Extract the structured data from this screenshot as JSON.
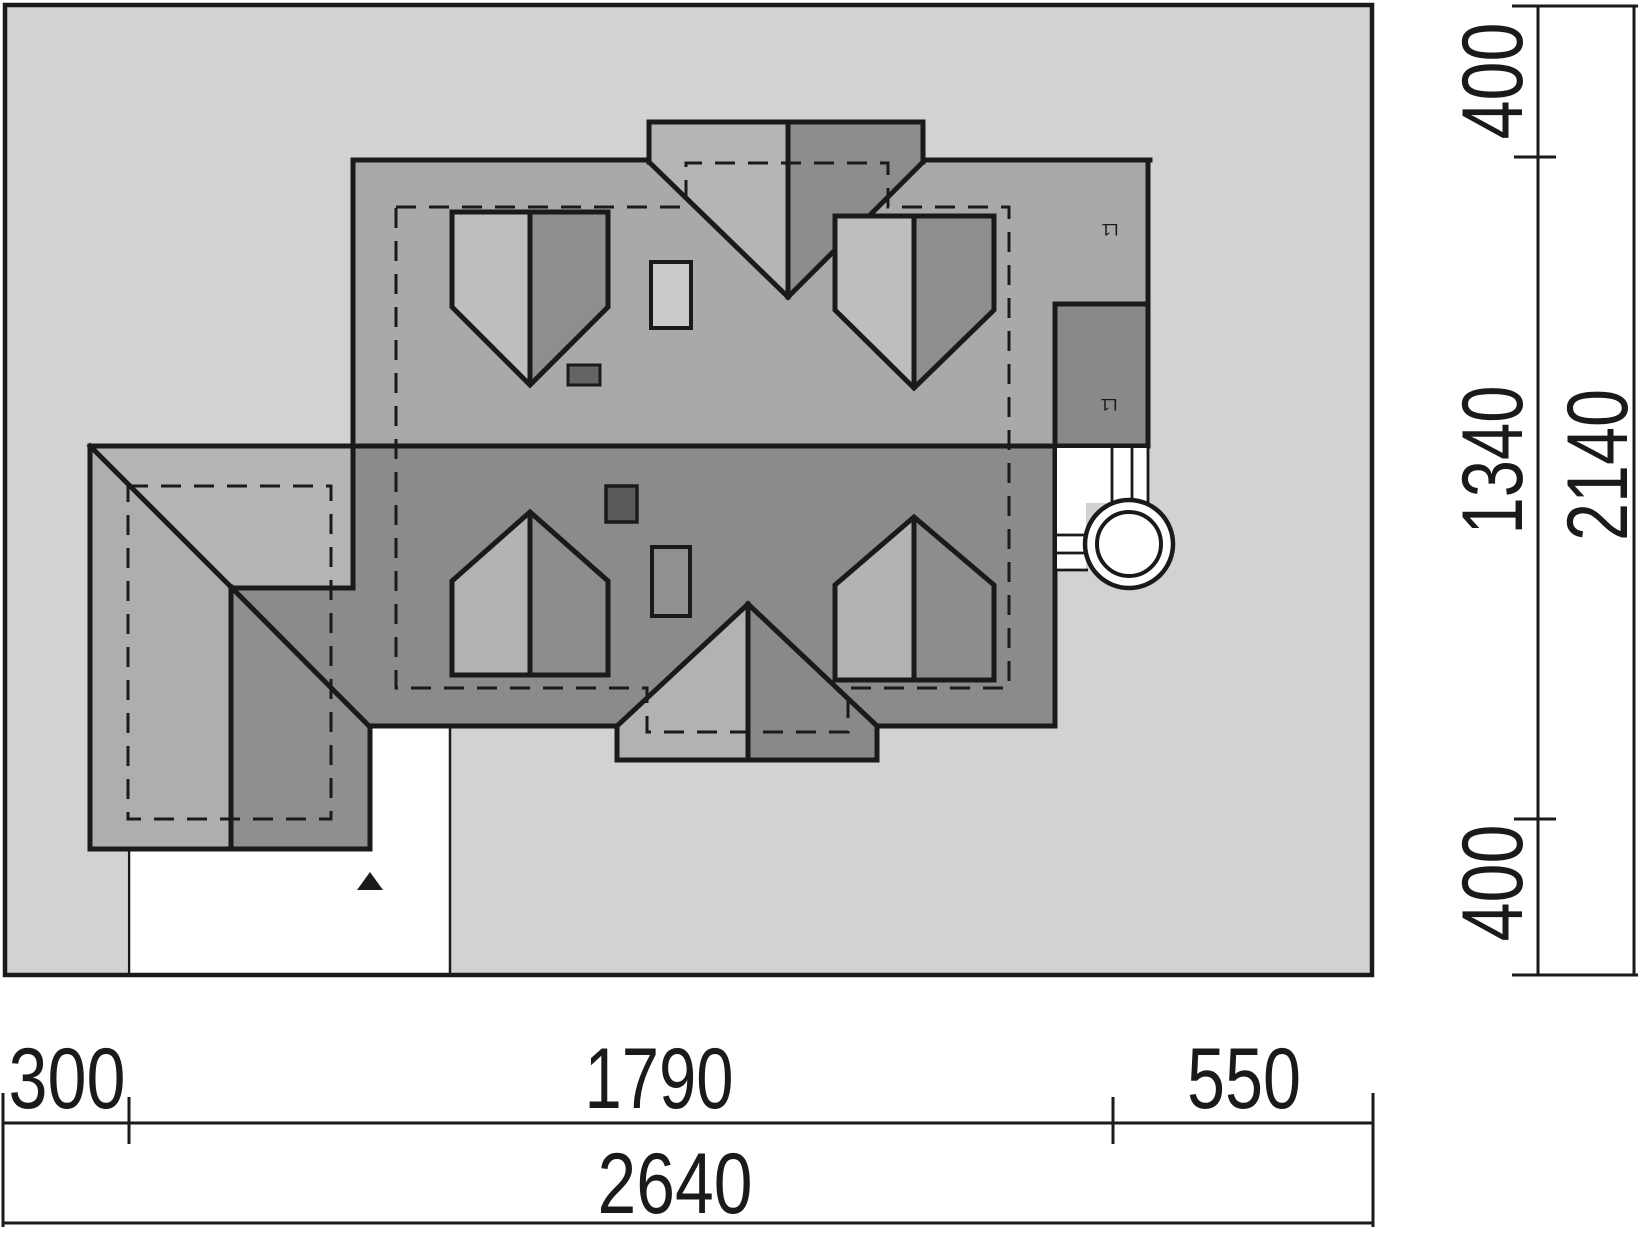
{
  "drawing": {
    "title": "site-roof-plan",
    "bottom_dims": {
      "seg_left": "300",
      "seg_mid": "1790",
      "seg_right": "550",
      "total": "2640"
    },
    "right_dims": {
      "seg_top": "400",
      "seg_mid": "1340",
      "seg_bottom": "400",
      "total": "2140"
    },
    "roof_marks": {
      "mark_upper": "L1",
      "mark_lower": "L1"
    },
    "colors": {
      "page": "#ffffff",
      "plot": "#d2d2d2",
      "outline": "#1a1a1a",
      "roof_upper": "#a9a9a9",
      "roof_lower": "#8b8b8b",
      "garage_north": "#b5b5b5",
      "garage_west": "#aeaeae",
      "garage_se": "#8f8f8f",
      "dormer_top_light": "#b5b5b5",
      "dormer_top_dark": "#8d8d8d",
      "dormer_bottom_light": "#b2b2b2",
      "dormer_bottom_dark": "#898989",
      "skylight_upper_light": "#bebebe",
      "skylight_upper_dark": "#8e8e8e",
      "skylight_lower_light": "#b3b3b3",
      "skylight_lower_dark": "#8d8d8d",
      "chimney": "#898989",
      "hatch_light": "#cacaca",
      "hatch_dark": "#909090",
      "vent_dark_a": "#646464",
      "vent_dark_b": "#5a5a5a",
      "service_white": "#ffffff"
    }
  }
}
